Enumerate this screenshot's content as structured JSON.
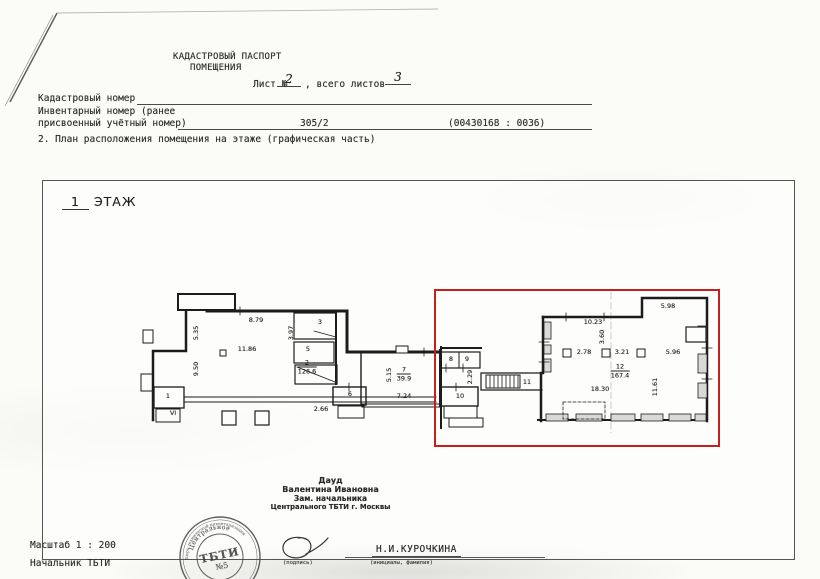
{
  "colors": {
    "highlight_red": "#c42020",
    "ink": "#2e2e2e",
    "plan_line": "#1c1c1c",
    "paper": "#fbfbf8"
  },
  "header": {
    "title_line1": "КАДАСТРОВЫЙ ПАСПОРТ",
    "title_line2": "ПОМЕЩЕНИЯ",
    "sheet_label": "Лист №",
    "sheet_number": "2",
    "sheet_total_label": ",  всего листов",
    "sheet_total": "3",
    "cadastral_label": "Кадастровый номер",
    "inventory_label_line1": "Инвентарный номер (ранее",
    "inventory_label_line2": "присвоенный учётный номер)",
    "inventory_value": "305/2",
    "inventory_code": "(00430168 : 0036)",
    "section_title": "2. План расположения помещения на этаже (графическая часть)"
  },
  "plan": {
    "floor_title_number": "1",
    "floor_title_word": "ЭТАЖ",
    "dim_labels": [
      {
        "t": "8.79",
        "x": 256,
        "y": 320
      },
      {
        "t": "5.35",
        "x": 196,
        "y": 333,
        "rot": 1
      },
      {
        "t": "9.50",
        "x": 196,
        "y": 369,
        "rot": 1
      },
      {
        "t": "11.86",
        "x": 247,
        "y": 349
      },
      {
        "t": "3.97",
        "x": 291,
        "y": 333,
        "rot": 1
      },
      {
        "t": "3",
        "x": 320,
        "y": 322
      },
      {
        "t": "5",
        "x": 308,
        "y": 349
      },
      {
        "t": "1",
        "x": 168,
        "y": 396
      },
      {
        "t": "VI",
        "x": 173,
        "y": 413
      },
      {
        "t": "2.66",
        "x": 321,
        "y": 409
      },
      {
        "t": "6",
        "x": 350,
        "y": 394
      },
      {
        "t": "5.15",
        "x": 389,
        "y": 375,
        "rot": 1
      },
      {
        "t": "7.24",
        "x": 404,
        "y": 396
      },
      {
        "t": "8",
        "x": 451,
        "y": 359
      },
      {
        "t": "9",
        "x": 467,
        "y": 359
      },
      {
        "t": "2.29",
        "x": 470,
        "y": 377,
        "rot": 1
      },
      {
        "t": "10",
        "x": 460,
        "y": 396
      },
      {
        "t": "11",
        "x": 527,
        "y": 382
      },
      {
        "t": "10.23",
        "x": 593,
        "y": 322
      },
      {
        "t": "5.98",
        "x": 668,
        "y": 306
      },
      {
        "t": "3.60",
        "x": 602,
        "y": 337,
        "rot": 1
      },
      {
        "t": "2.78",
        "x": 584,
        "y": 352
      },
      {
        "t": "3.21",
        "x": 622,
        "y": 352
      },
      {
        "t": "5.96",
        "x": 673,
        "y": 352
      },
      {
        "t": "18.30",
        "x": 600,
        "y": 389
      },
      {
        "t": "11.61",
        "x": 655,
        "y": 387,
        "rot": 1
      }
    ],
    "room_stamps": [
      {
        "num": "2",
        "area": "126.6",
        "x": 307,
        "y": 367
      },
      {
        "num": "7",
        "area": "39.9",
        "x": 404,
        "y": 374
      },
      {
        "num": "12",
        "area": "167.4",
        "x": 620,
        "y": 371
      }
    ]
  },
  "signature_block": {
    "name_line1": "Дауд",
    "name_line2": "Валентина Ивановна",
    "title_line1": "Зам. начальника",
    "title_line2": "Центрального ТБТИ г. Москвы"
  },
  "stamp": {
    "ring_text": "Бюро технической инвентаризации",
    "top_text": "Центральное",
    "center_line1": "ТБТИ",
    "center_line2": "№5"
  },
  "footer": {
    "scale": "Масштаб 1 : 200",
    "chief": "Начальник ТБТИ",
    "signature_caption": "(подпись)",
    "name": "Н.И.КУРОЧКИНА",
    "name_caption": "(инициалы, фамилия)"
  }
}
